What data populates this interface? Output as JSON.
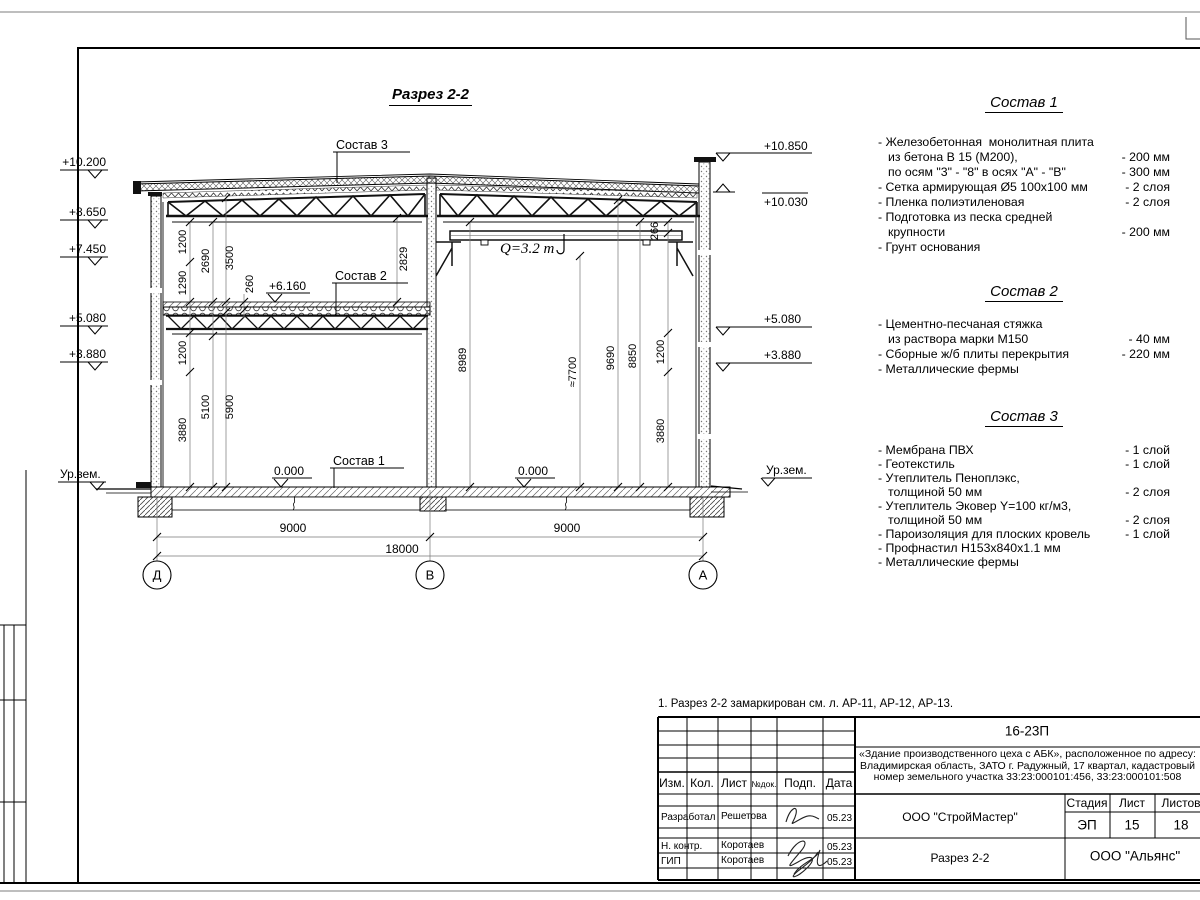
{
  "sheet": {
    "note": "1. Разрез 2-2 замаркирован см. л. АР-11, АР-12, АР-13."
  },
  "drawing": {
    "title": "Разрез 2-2",
    "elevations_left": [
      "+10.200",
      "+8.650",
      "+7.450",
      "+5.080",
      "+3.880"
    ],
    "elevations_right": [
      "+10.850",
      "+10.030",
      "+5.080",
      "+3.880"
    ],
    "ground_left": "Ур.зем.",
    "ground_right": "Ур.зем.",
    "levels": {
      "zero_left": "0.000",
      "zero_right": "0.000",
      "mid": "+6.160"
    },
    "callouts": {
      "c1": "Состав 1",
      "c2": "Состав 2",
      "c3": "Состав 3"
    },
    "crane": "Q=3.2 т",
    "grid": [
      "Д",
      "В",
      "А"
    ],
    "dims_bottom": [
      "9000",
      "9000",
      "18000"
    ],
    "dims_left": [
      "1200",
      "2690",
      "3500",
      "1290",
      "260",
      "2829",
      "1200",
      "5100",
      "5900",
      "3880"
    ],
    "dims_right": [
      "266",
      "8989",
      "≈7700",
      "9690",
      "8850",
      "1200",
      "3880"
    ]
  },
  "compositions": [
    {
      "title": "Состав 1",
      "rows": [
        {
          "t": "- Железобетонная  монолитная плита",
          "v": ""
        },
        {
          "t": "из бетона В 15 (М200),",
          "v": "- 200 мм"
        },
        {
          "t": "по осям \"3\" - \"8\" в осях \"А\" - \"В\"",
          "v": "- 300 мм"
        },
        {
          "t": "- Сетка армирующая Ø5 100х100 мм",
          "v": "- 2 слоя"
        },
        {
          "t": "- Пленка полиэтиленовая",
          "v": "-  2 слоя"
        },
        {
          "t": "- Подготовка из песка средней",
          "v": ""
        },
        {
          "t": "крупности",
          "v": "- 200 мм"
        },
        {
          "t": "- Грунт основания",
          "v": ""
        }
      ]
    },
    {
      "title": "Состав 2",
      "rows": [
        {
          "t": "- Цементно-песчаная стяжка",
          "v": ""
        },
        {
          "t": "из раствора марки М150",
          "v": "- 40 мм"
        },
        {
          "t": "- Сборные ж/б плиты перекрытия",
          "v": "- 220 мм"
        },
        {
          "t": "- Металлические фермы",
          "v": ""
        }
      ]
    },
    {
      "title": "Состав 3",
      "rows": [
        {
          "t": "- Мембрана ПВХ",
          "v": "- 1 слой"
        },
        {
          "t": "- Геотекстиль",
          "v": "- 1 слой"
        },
        {
          "t": "- Утеплитель Пеноплэкс,",
          "v": ""
        },
        {
          "t": "толщиной 50 мм",
          "v": "- 2 слоя"
        },
        {
          "t": "- Утеплитель Эковер Y=100 кг/м3,",
          "v": ""
        },
        {
          "t": "толщиной 50 мм",
          "v": "- 2 слоя"
        },
        {
          "t": "- Пароизоляция для плоских кровель",
          "v": "- 1 слой"
        },
        {
          "t": "- Профнастил Н153х840х1.1 мм",
          "v": ""
        },
        {
          "t": "- Металлические фермы",
          "v": ""
        }
      ]
    }
  ],
  "titleblock": {
    "doc_number": "16-23П",
    "description_lines": "«Здание производственного цеха с АБК», расположенное по адресу: Владимирская область, ЗАТО г. Радужный, 17 квартал, кадастровый номер земельного участка 33:23:000101:456, 33:23:000101:508",
    "col_izm": "Изм.",
    "col_kol": "Кол.",
    "col_list": "Лист",
    "col_ndok": "№док.",
    "col_podp": "Подп.",
    "col_data": "Дата",
    "rows": [
      {
        "role": "Разработал",
        "name": "Решетова",
        "date": "05.23"
      },
      {
        "role": "Н. контр.",
        "name": "Коротаев",
        "date": "05.23"
      },
      {
        "role": "ГИП",
        "name": "Коротаев",
        "date": "05.23"
      }
    ],
    "company": "ООО \"СтройМастер\"",
    "stage_label": "Стадия",
    "sheet_label": "Лист",
    "sheets_label": "Листов",
    "stage": "ЭП",
    "sheet_no": "15",
    "sheets_total": "18",
    "section_name": "Разрез 2-2",
    "org": "ООО \"Альянс\""
  }
}
